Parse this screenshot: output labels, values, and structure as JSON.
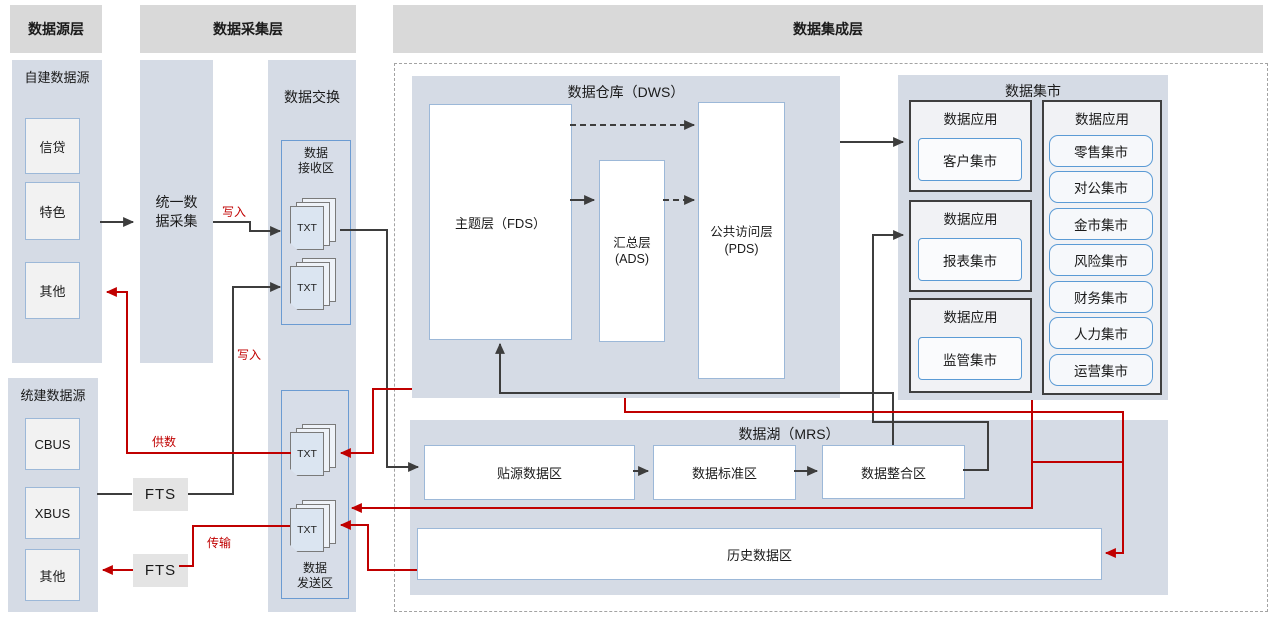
{
  "headers": {
    "source": "数据源层",
    "collection": "数据采集层",
    "integration": "数据集成层"
  },
  "source_panel": {
    "title": "自建数据源",
    "items": [
      "信贷",
      "特色",
      "其他"
    ]
  },
  "gov_panel": {
    "title": "统建数据源",
    "items": [
      "CBUS",
      "XBUS",
      "其他"
    ]
  },
  "collector": {
    "label": "统一数\n据采集"
  },
  "fts": {
    "label": "FTS"
  },
  "exchange": {
    "title": "数据交换",
    "receive_label": "数据\n接收区",
    "send_label": "数据\n发送区",
    "file_label": "TXT"
  },
  "dws": {
    "title": "数据仓库（DWS）",
    "subject": "主题层（FDS）",
    "summary": "汇总层\n(ADS)",
    "public": "公共访问层\n(PDS)"
  },
  "mart": {
    "title": "数据集市",
    "apps": [
      {
        "label": "数据应用",
        "item": "客户集市"
      },
      {
        "label": "数据应用",
        "item": "报表集市"
      },
      {
        "label": "数据应用",
        "item": "监管集市"
      }
    ],
    "right_group": {
      "label": "数据应用",
      "items": [
        "零售集市",
        "对公集市",
        "金市集市",
        "风险集市",
        "财务集市",
        "人力集市",
        "运营集市"
      ]
    }
  },
  "lake": {
    "title": "数据湖（MRS）",
    "zones": [
      "贴源数据区",
      "数据标准区",
      "数据整合区"
    ],
    "history": "历史数据区"
  },
  "flow_labels": {
    "write1": "写入",
    "write2": "写入",
    "supply": "供数",
    "transfer": "传输"
  },
  "colors": {
    "red": "#c00000",
    "line": "#3d3d3d",
    "panel": "#d5dbe5",
    "header": "#d9d9d9",
    "blue_border": "#5b9bd5"
  }
}
